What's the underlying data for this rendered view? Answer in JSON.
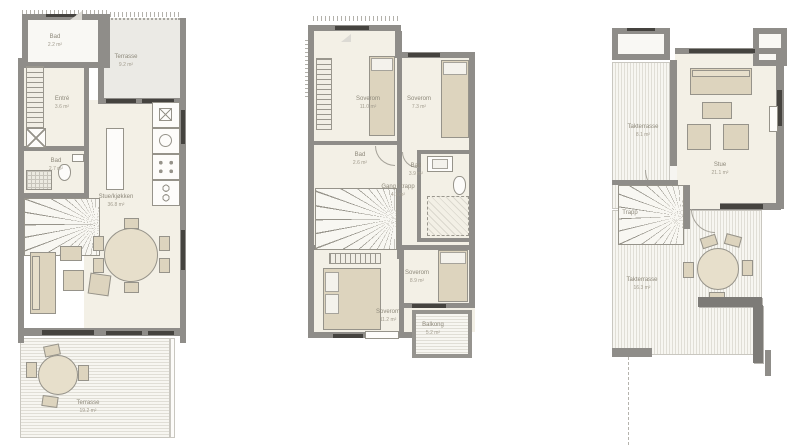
{
  "colors": {
    "wall": "#8f8d89",
    "wall_dark": "#7d7b77",
    "floor": "#f3f0e6",
    "furniture": "#ddd4be",
    "deck_line": "#e0ded6",
    "window": "#45433f",
    "label_text": "#8e897b"
  },
  "plans": [
    {
      "name": "first-floor-plan",
      "rooms": [
        {
          "label": "Bad",
          "area": "2.2 m²"
        },
        {
          "label": "Terrasse",
          "area": "9.2 m²"
        },
        {
          "label": "Entré",
          "area": "3.6 m²"
        },
        {
          "label": "Bad",
          "area": "2.7 m²"
        },
        {
          "label": "Stue/kjøkken",
          "area": "36.8 m²"
        },
        {
          "label": "Terrasse",
          "area": "19.2 m²"
        }
      ]
    },
    {
      "name": "second-floor-plan",
      "rooms": [
        {
          "label": "Soverom",
          "area": "11.0 m²"
        },
        {
          "label": "Soverom",
          "area": "7.3 m²"
        },
        {
          "label": "Bad",
          "area": "2.6 m²"
        },
        {
          "label": "Gang / trapp",
          "area": "4.1 m²"
        },
        {
          "label": "Bad",
          "area": "3.9 m²"
        },
        {
          "label": "Soverom",
          "area": "11.2 m²"
        },
        {
          "label": "Soverom",
          "area": "8.9 m²"
        },
        {
          "label": "Balkong",
          "area": "5.2 m²"
        }
      ]
    },
    {
      "name": "roof-terrace-plan",
      "rooms": [
        {
          "label": "Takterrasse",
          "area": "8.1 m²"
        },
        {
          "label": "Stue",
          "area": "21.1 m²"
        },
        {
          "label": "Trapp",
          "area": ""
        },
        {
          "label": "Takterrasse",
          "area": "16.3 m²"
        }
      ]
    }
  ]
}
